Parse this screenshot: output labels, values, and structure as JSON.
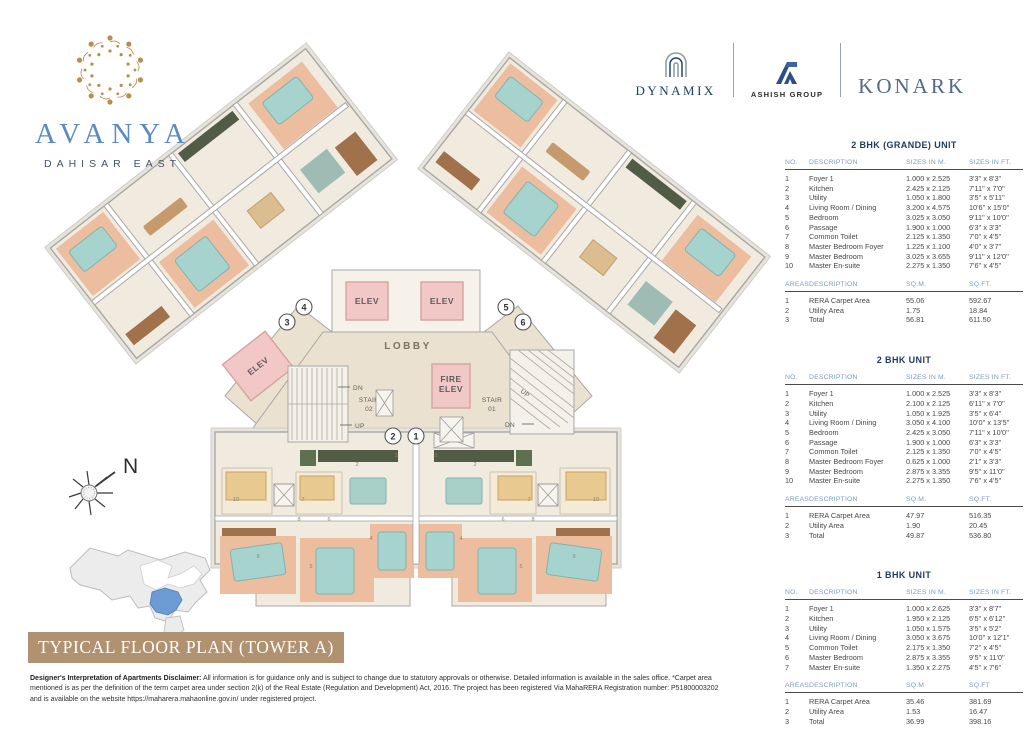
{
  "brand": {
    "name": "AVANYA",
    "location": "DAHISAR EAST"
  },
  "partners": {
    "dynamix": "DYNAMIX",
    "ashish": "ASHISH GROUP",
    "konark": "KONARK"
  },
  "banner": {
    "title": "TYPICAL FLOOR PLAN (TOWER A)"
  },
  "disclaimer": {
    "lead": "Designer's Interpretation of Apartments Disclaimer:",
    "body": " All information is for guidance only and is subject to change due to statutory approvals or otherwise. Detailed information is available in the sales office. *Carpet area mentioned is as per the definition of the term carpet area under section 2(k) of the Real Estate (Regulation and Development) Act, 2016. The project has been registered Via MahaRERA Registration number: P51800003202 and is available on the website https://maharera.mahaonline.gov.in/ under registered project."
  },
  "floor_plan": {
    "labels": {
      "lobby": "LOBBY",
      "elev": "ELEV",
      "fire_1": "FIRE",
      "fire_2": "ELEV",
      "stair": "STAIR",
      "stair_no_1": "01",
      "stair_no_2": "02",
      "dn": "DN",
      "up": "UP",
      "north": "N"
    },
    "unit_markers": [
      "1",
      "2",
      "3",
      "4",
      "5",
      "6"
    ],
    "room_labels": [
      {
        "n": "1",
        "x": 396,
        "y": 457
      },
      {
        "n": "2",
        "x": 357,
        "y": 466
      },
      {
        "n": "4",
        "x": 371,
        "y": 540
      },
      {
        "n": "5",
        "x": 311,
        "y": 568
      },
      {
        "n": "6",
        "x": 329,
        "y": 521
      },
      {
        "n": "7",
        "x": 303,
        "y": 501
      },
      {
        "n": "8",
        "x": 299,
        "y": 521
      },
      {
        "n": "9",
        "x": 258,
        "y": 558
      },
      {
        "n": "10",
        "x": 236,
        "y": 501
      }
    ]
  },
  "tables": [
    {
      "title": "2 BHK (GRANDE) UNIT",
      "headers": [
        "NO.",
        "DESCRIPTION",
        "SIZES IN M.",
        "SIZES IN FT."
      ],
      "rows": [
        [
          "1",
          "Foyer 1",
          "1.000 x 2.525",
          "3'3'' x 8'3''"
        ],
        [
          "2",
          "Kitchen",
          "2.425 x 2.125",
          "7'11'' x 7'0''"
        ],
        [
          "3",
          "Utility",
          "1.050 x 1.800",
          "3'5'' x 5'11''"
        ],
        [
          "4",
          "Living Room / Dining",
          "3.200 x 4.575",
          "10'6'' x 15'0''"
        ],
        [
          "5",
          "Bedroom",
          "3.025 x 3.050",
          "9'11'' x 10'0''"
        ],
        [
          "6",
          "Passage",
          "1.900 x 1.000",
          "6'3'' x 3'3''"
        ],
        [
          "7",
          "Common Toilet",
          "2.125 x 1.350",
          "7'0'' x 4'5''"
        ],
        [
          "8",
          "Master Bedroom Foyer",
          "1.225 x 1.100",
          "4'0'' x 3'7''"
        ],
        [
          "9",
          "Master Bedroom",
          "3.025 x 3.655",
          "9'11'' x 12'0''"
        ],
        [
          "10",
          "Master En-suite",
          "2.275 x 1.350",
          "7'6'' x 4'5''"
        ]
      ],
      "area_headers": [
        "AREAS",
        "DESCRIPTION",
        "SQ.M.",
        "SQ.FT."
      ],
      "area_rows": [
        [
          "1",
          "RERA Carpet Area",
          "55.06",
          "592.67"
        ],
        [
          "2",
          "Utility Area",
          "1.75",
          "18.84"
        ],
        [
          "3",
          "Total",
          "56.81",
          "611.50"
        ]
      ]
    },
    {
      "title": "2 BHK UNIT",
      "headers": [
        "NO.",
        "DESCRIPTION",
        "SIZES IN M.",
        "SIZES IN FT."
      ],
      "rows": [
        [
          "1",
          "Foyer 1",
          "1.000 x 2.525",
          "3'3'' x 8'3''"
        ],
        [
          "2",
          "Kitchen",
          "2.100 x 2.125",
          "6'11'' x 7'0''"
        ],
        [
          "3",
          "Utility",
          "1.050 x 1.925",
          "3'5'' x 6'4''"
        ],
        [
          "4",
          "Living Room / Dining",
          "3.050 x 4.100",
          "10'0'' x 13'5''"
        ],
        [
          "5",
          "Bedroom",
          "2.425 x 3.050",
          "7'11'' x 10'0''"
        ],
        [
          "6",
          "Passage",
          "1.900 x 1.000",
          "6'3'' x 3'3''"
        ],
        [
          "7",
          "Common Toilet",
          "2.125 x 1.350",
          "7'0'' x 4'5''"
        ],
        [
          "8",
          "Master Bedroom Foyer",
          "0.625 x 1.000",
          "2'1'' x 3'3''"
        ],
        [
          "9",
          "Master Bedroom",
          "2.875 x 3.355",
          "9'5'' x 11'0''"
        ],
        [
          "10",
          "Master En-suite",
          "2.275 x 1.350",
          "7'6'' x 4'5''"
        ]
      ],
      "area_headers": [
        "AREAS",
        "DESCRIPTION",
        "SQ.M.",
        "SQ.FT."
      ],
      "area_rows": [
        [
          "1",
          "RERA Carpet Area",
          "47.97",
          "516.35"
        ],
        [
          "2",
          "Utility Area",
          "1.90",
          "20.45"
        ],
        [
          "3",
          "Total",
          "49.87",
          "536.80"
        ]
      ]
    },
    {
      "title": "1 BHK UNIT",
      "headers": [
        "NO.",
        "DESCRIPTION",
        "SIZES IN M.",
        "SIZES IN FT."
      ],
      "rows": [
        [
          "1",
          "Foyer 1",
          "1.000 x 2.625",
          "3'3'' x 8'7''"
        ],
        [
          "2",
          "Kitchen",
          "1.950 x 2.125",
          "6'5'' x 6'12''"
        ],
        [
          "3",
          "Utility",
          "1.050 x 1.575",
          "3'5'' x 5'2''"
        ],
        [
          "4",
          "Living Room / Dining",
          "3.050 x 3.675",
          "10'0'' x 12'1''"
        ],
        [
          "5",
          "Common Toilet",
          "2.175 x 1.350",
          "7'2'' x 4'5''"
        ],
        [
          "6",
          "Master Bedroom",
          "2.875 x 3.355",
          "9'5'' x 11'0''"
        ],
        [
          "7",
          "Master En-suite",
          "1.350 x 2.275",
          "4'5'' x 7'6''"
        ]
      ],
      "area_headers": [
        "AREAS",
        "DESCRIPTION",
        "SQ.M",
        "SQ.FT"
      ],
      "area_rows": [
        [
          "1",
          "RERA Carpet Area",
          "35.46",
          "381.69"
        ],
        [
          "2",
          "Utility Area",
          "1.53",
          "16.47"
        ],
        [
          "3",
          "Total",
          "36.99",
          "398.16"
        ]
      ]
    }
  ],
  "colors": {
    "accent_navy": "#1e3a5f",
    "header_blue": "#7d9cc0",
    "banner_tan": "#b09170",
    "brand_blue": "#5b8ac0",
    "logo_gold": "#b98d4f",
    "elev_pink": "#f2c8c7",
    "bedroom_peach": "#ecbd9e",
    "bed_teal": "#a7d3cf",
    "site_highlight_blue": "#6d9bd3"
  }
}
